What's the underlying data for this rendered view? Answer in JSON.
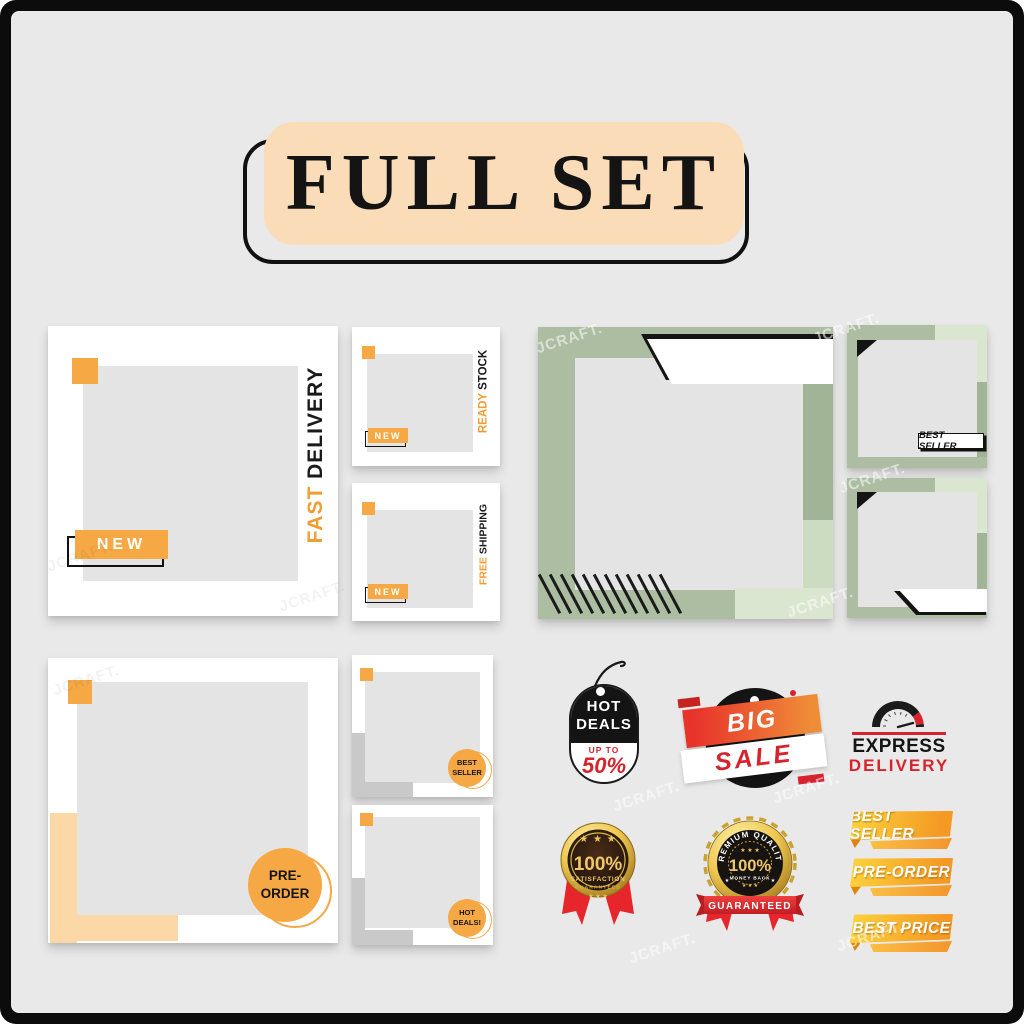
{
  "title": "FULL SET",
  "watermark": {
    "text": "JCRAFT."
  },
  "templates": {
    "fast_delivery": {
      "tag": "NEW",
      "word_accent": "FAST",
      "word_dark": "DELIVERY"
    },
    "ready_stock": {
      "tag": "NEW",
      "word_accent": "READY",
      "word_dark": "STOCK"
    },
    "free_shipping": {
      "tag": "NEW",
      "word_accent": "FREE",
      "word_dark": "SHIPPING"
    },
    "green_best_seller": {
      "label": "BEST SELLER"
    },
    "pre_order": {
      "line1": "PRE-",
      "line2": "ORDER"
    },
    "best_seller_circle": {
      "line1": "BEST",
      "line2": "SELLER"
    },
    "hot_deals_circle": {
      "line1": "HOT",
      "line2": "DEALS!"
    }
  },
  "badges": {
    "hot_deals_tag": {
      "line1": "HOT",
      "line2": "DEALS",
      "sub": "UP TO",
      "value": "50%"
    },
    "big_sale": {
      "line1": "BIG",
      "line2": "SALE"
    },
    "express_delivery": {
      "line1": "EXPRESS",
      "line2": "DELIVERY"
    },
    "satisfaction": {
      "value": "100%",
      "line1": "SATISFACTION",
      "line2": "GUARANTEED",
      "stars_top": "★ ★ ★",
      "stars_bottom": "★ ★ ★"
    },
    "premium": {
      "arc_text": "PREMIUM QUALITY",
      "value": "100%",
      "sub": "MONEY BACK",
      "banner": "GUARANTEED",
      "stars_top": "★ ★ ★",
      "stars_bottom": "★ ★ ★",
      "star": "★"
    },
    "ribbons": [
      {
        "label": "BEST SELLER"
      },
      {
        "label": "PRE-ORDER"
      },
      {
        "label": "BEST PRICE"
      }
    ]
  },
  "colors": {
    "orange": "#F5A843",
    "peach": "#FBDCB8",
    "light_peach": "#FBD8A5",
    "sage_green": "#ACBDA1",
    "light_green": "#DBE6D0",
    "red": "#D6232E",
    "gold": "#EEC84F",
    "black": "#141414",
    "background": "#E9E9E9"
  }
}
